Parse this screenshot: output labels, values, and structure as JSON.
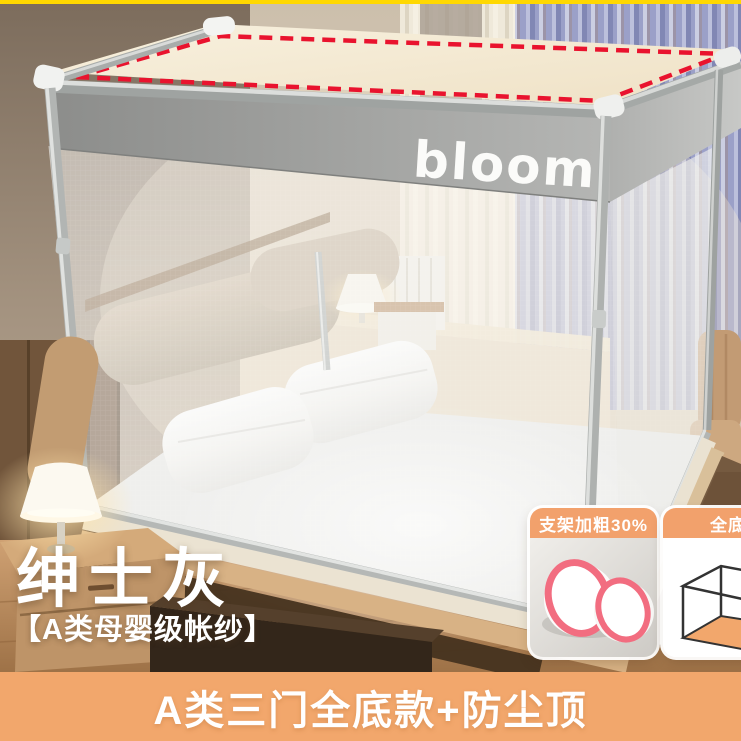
{
  "decor": {
    "top_strip_color": "#FFD800",
    "accent_orange": "#F2A76C",
    "badge_header_orange": "#F2A16C",
    "dashed_outline_color": "#E9132E",
    "ring_pink": "#F26D80"
  },
  "canopy": {
    "brand": "bloom"
  },
  "overlay": {
    "title": "绅士灰",
    "subtitle": "【A类母婴级帐纱】"
  },
  "badges": [
    {
      "label": "支架加粗30%",
      "icon": "thickened-poles-icon"
    },
    {
      "label": "全底",
      "icon": "full-bottom-box-icon"
    }
  ],
  "banner": {
    "text": "A类三门全底款+防尘顶"
  }
}
